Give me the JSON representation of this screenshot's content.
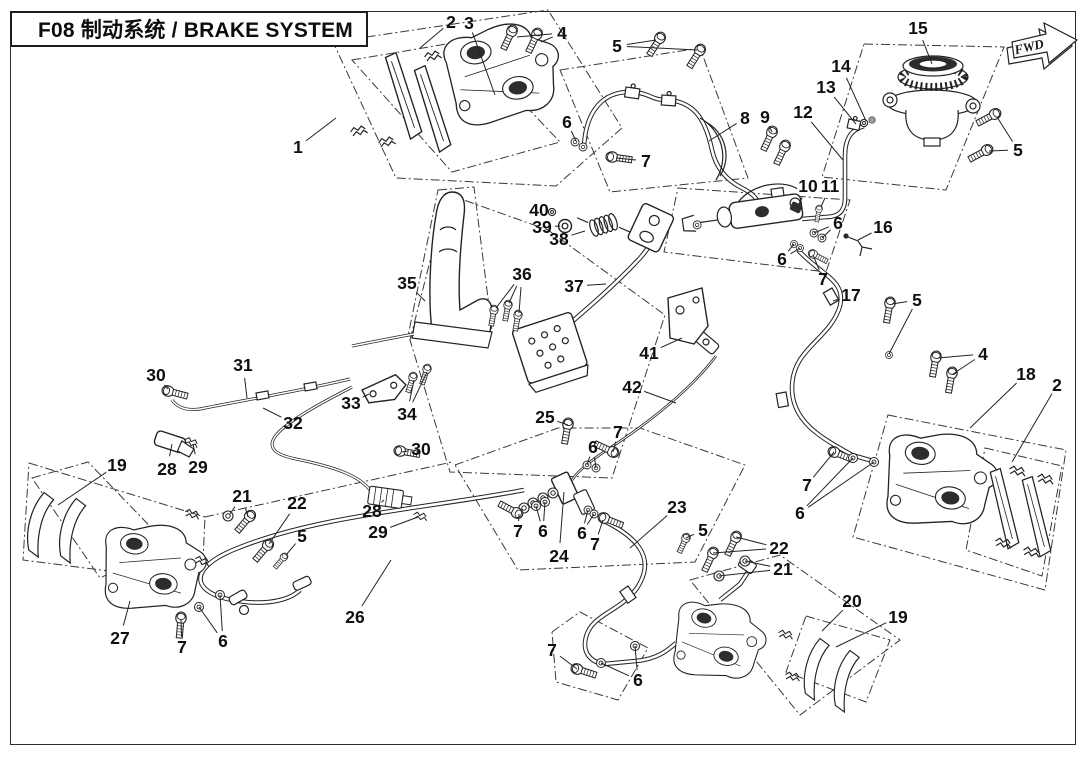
{
  "page": {
    "title": "F08 制动系统 / BRAKE SYSTEM",
    "fwd_label": "FWD",
    "line_color": "#232323",
    "background": "#ffffff"
  },
  "callouts": [
    {
      "n": "1",
      "x": 298,
      "y": 147,
      "t": [
        [
          336,
          118
        ]
      ]
    },
    {
      "n": "2",
      "x": 451,
      "y": 22,
      "t": [
        [
          420,
          48
        ]
      ]
    },
    {
      "n": "3",
      "x": 469,
      "y": 23,
      "t": [
        [
          495,
          95
        ]
      ]
    },
    {
      "n": "4",
      "x": 562,
      "y": 33,
      "t": [
        [
          517,
          37
        ],
        [
          541,
          42
        ]
      ]
    },
    {
      "n": "5",
      "x": 617,
      "y": 46,
      "t": [
        [
          656,
          40
        ],
        [
          697,
          50
        ]
      ]
    },
    {
      "n": "6",
      "x": 567,
      "y": 122,
      "t": [
        [
          576,
          141
        ]
      ]
    },
    {
      "n": "7",
      "x": 646,
      "y": 161,
      "t": [
        [
          616,
          158
        ]
      ]
    },
    {
      "n": "8",
      "x": 745,
      "y": 118,
      "t": [
        [
          709,
          141
        ]
      ]
    },
    {
      "n": "9",
      "x": 765,
      "y": 117,
      "t": [
        [
          772,
          132
        ]
      ]
    },
    {
      "n": "12",
      "x": 803,
      "y": 112,
      "t": [
        [
          843,
          160
        ]
      ]
    },
    {
      "n": "13",
      "x": 826,
      "y": 87,
      "t": [
        [
          856,
          124
        ]
      ]
    },
    {
      "n": "14",
      "x": 841,
      "y": 66,
      "t": [
        [
          866,
          121
        ]
      ]
    },
    {
      "n": "15",
      "x": 918,
      "y": 28,
      "t": [
        [
          932,
          64
        ]
      ]
    },
    {
      "n": "5",
      "x": 1018,
      "y": 150,
      "t": [
        [
          997,
          117
        ],
        [
          989,
          151
        ]
      ]
    },
    {
      "n": "10",
      "x": 808,
      "y": 186,
      "t": [
        [
          799,
          204
        ]
      ]
    },
    {
      "n": "11",
      "x": 830,
      "y": 186,
      "t": [
        [
          821,
          207
        ]
      ]
    },
    {
      "n": "6",
      "x": 838,
      "y": 223,
      "t": [
        [
          814,
          233
        ],
        [
          822,
          238
        ]
      ]
    },
    {
      "n": "16",
      "x": 883,
      "y": 227,
      "t": [
        [
          858,
          240
        ]
      ]
    },
    {
      "n": "6",
      "x": 782,
      "y": 259,
      "t": [
        [
          794,
          244
        ],
        [
          800,
          248
        ]
      ]
    },
    {
      "n": "7",
      "x": 823,
      "y": 279,
      "t": [
        [
          813,
          255
        ]
      ]
    },
    {
      "n": "17",
      "x": 851,
      "y": 295,
      "t": [
        [
          833,
          301
        ]
      ]
    },
    {
      "n": "5",
      "x": 917,
      "y": 300,
      "t": [
        [
          892,
          304
        ],
        [
          889,
          354
        ]
      ]
    },
    {
      "n": "4",
      "x": 983,
      "y": 354,
      "t": [
        [
          938,
          358
        ],
        [
          953,
          374
        ]
      ]
    },
    {
      "n": "18",
      "x": 1026,
      "y": 374,
      "t": [
        [
          970,
          428
        ]
      ]
    },
    {
      "n": "2",
      "x": 1057,
      "y": 385,
      "t": [
        [
          1012,
          462
        ]
      ]
    },
    {
      "n": "40",
      "x": 539,
      "y": 210,
      "t": [
        [
          552,
          212
        ]
      ]
    },
    {
      "n": "39",
      "x": 542,
      "y": 227,
      "t": [
        [
          560,
          226
        ]
      ]
    },
    {
      "n": "38",
      "x": 559,
      "y": 239,
      "t": [
        [
          585,
          231
        ]
      ]
    },
    {
      "n": "35",
      "x": 407,
      "y": 283,
      "t": [
        [
          425,
          301
        ]
      ]
    },
    {
      "n": "36",
      "x": 522,
      "y": 274,
      "t": [
        [
          496,
          308
        ],
        [
          509,
          303
        ],
        [
          519,
          313
        ]
      ]
    },
    {
      "n": "37",
      "x": 574,
      "y": 286,
      "t": [
        [
          606,
          284
        ]
      ]
    },
    {
      "n": "41",
      "x": 649,
      "y": 353,
      "t": [
        [
          682,
          338
        ]
      ]
    },
    {
      "n": "42",
      "x": 632,
      "y": 387,
      "t": [
        [
          676,
          403
        ]
      ]
    },
    {
      "n": "30",
      "x": 156,
      "y": 375,
      "t": [
        [
          168,
          389
        ]
      ]
    },
    {
      "n": "31",
      "x": 243,
      "y": 365,
      "t": [
        [
          247,
          398
        ]
      ]
    },
    {
      "n": "32",
      "x": 293,
      "y": 423,
      "t": [
        [
          263,
          408
        ]
      ]
    },
    {
      "n": "33",
      "x": 351,
      "y": 403,
      "t": [
        [
          369,
          394
        ]
      ]
    },
    {
      "n": "34",
      "x": 407,
      "y": 414,
      "t": [
        [
          414,
          380
        ],
        [
          427,
          372
        ]
      ]
    },
    {
      "n": "19",
      "x": 117,
      "y": 465,
      "t": [
        [
          58,
          505
        ]
      ]
    },
    {
      "n": "28",
      "x": 167,
      "y": 469,
      "t": [
        [
          172,
          444
        ]
      ]
    },
    {
      "n": "29",
      "x": 198,
      "y": 467,
      "t": [
        [
          193,
          444
        ]
      ]
    },
    {
      "n": "25",
      "x": 545,
      "y": 417,
      "t": [
        [
          568,
          425
        ]
      ]
    },
    {
      "n": "30",
      "x": 421,
      "y": 449,
      "t": [
        [
          402,
          452
        ]
      ]
    },
    {
      "n": "7",
      "x": 618,
      "y": 432,
      "t": [
        [
          613,
          452
        ]
      ]
    },
    {
      "n": "6",
      "x": 593,
      "y": 447,
      "t": [
        [
          587,
          465
        ],
        [
          596,
          468
        ]
      ]
    },
    {
      "n": "28",
      "x": 372,
      "y": 511,
      "t": [
        [
          384,
          500
        ]
      ]
    },
    {
      "n": "29",
      "x": 378,
      "y": 532,
      "t": [
        [
          418,
          517
        ]
      ]
    },
    {
      "n": "21",
      "x": 242,
      "y": 496,
      "t": [
        [
          230,
          514
        ],
        [
          248,
          517
        ]
      ]
    },
    {
      "n": "22",
      "x": 297,
      "y": 503,
      "t": [
        [
          269,
          544
        ]
      ]
    },
    {
      "n": "5",
      "x": 302,
      "y": 536,
      "t": [
        [
          286,
          555
        ]
      ]
    },
    {
      "n": "7",
      "x": 518,
      "y": 531,
      "t": [
        [
          519,
          514
        ]
      ]
    },
    {
      "n": "6",
      "x": 543,
      "y": 531,
      "t": [
        [
          536,
          506
        ],
        [
          545,
          502
        ]
      ]
    },
    {
      "n": "24",
      "x": 559,
      "y": 556,
      "t": [
        [
          564,
          492
        ]
      ]
    },
    {
      "n": "6",
      "x": 582,
      "y": 533,
      "t": [
        [
          588,
          510
        ],
        [
          594,
          514
        ]
      ]
    },
    {
      "n": "7",
      "x": 595,
      "y": 544,
      "t": [
        [
          603,
          520
        ]
      ]
    },
    {
      "n": "23",
      "x": 677,
      "y": 507,
      "t": [
        [
          630,
          548
        ]
      ]
    },
    {
      "n": "5",
      "x": 703,
      "y": 530,
      "t": [
        [
          686,
          538
        ]
      ]
    },
    {
      "n": "22",
      "x": 779,
      "y": 548,
      "t": [
        [
          736,
          537
        ],
        [
          713,
          553
        ]
      ]
    },
    {
      "n": "21",
      "x": 783,
      "y": 569,
      "t": [
        [
          745,
          561
        ],
        [
          719,
          576
        ]
      ]
    },
    {
      "n": "7",
      "x": 807,
      "y": 485,
      "t": [
        [
          834,
          452
        ]
      ]
    },
    {
      "n": "6",
      "x": 800,
      "y": 513,
      "t": [
        [
          853,
          458
        ],
        [
          874,
          462
        ]
      ]
    },
    {
      "n": "26",
      "x": 355,
      "y": 617,
      "t": [
        [
          391,
          560
        ]
      ]
    },
    {
      "n": "27",
      "x": 120,
      "y": 638,
      "t": [
        [
          130,
          601
        ]
      ]
    },
    {
      "n": "7",
      "x": 182,
      "y": 647,
      "t": [
        [
          181,
          620
        ]
      ]
    },
    {
      "n": "6",
      "x": 223,
      "y": 641,
      "t": [
        [
          199,
          607
        ],
        [
          220,
          595
        ]
      ]
    },
    {
      "n": "7",
      "x": 552,
      "y": 650,
      "t": [
        [
          577,
          669
        ]
      ]
    },
    {
      "n": "6",
      "x": 638,
      "y": 680,
      "t": [
        [
          601,
          663
        ],
        [
          635,
          646
        ]
      ]
    },
    {
      "n": "20",
      "x": 852,
      "y": 601,
      "t": [
        [
          822,
          631
        ]
      ]
    },
    {
      "n": "19",
      "x": 898,
      "y": 617,
      "t": [
        [
          836,
          647
        ]
      ]
    }
  ]
}
